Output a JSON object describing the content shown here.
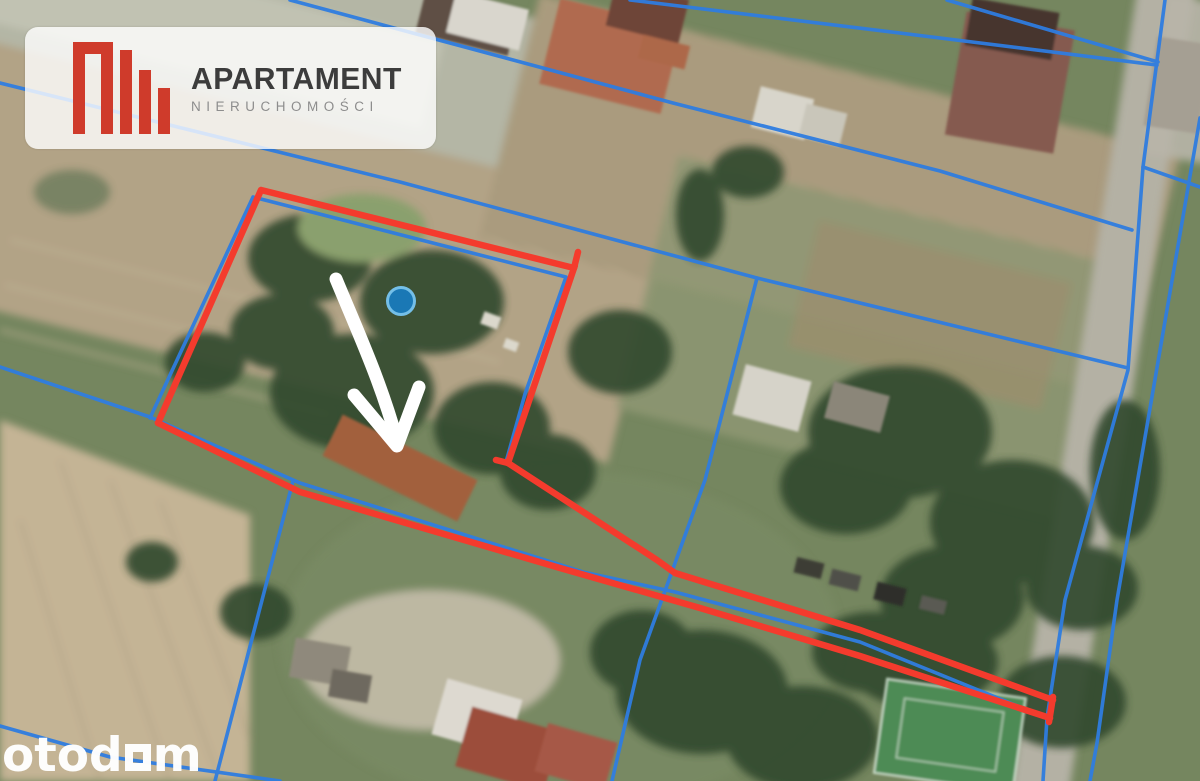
{
  "branding": {
    "agency": {
      "name": "APARTAMENT",
      "tagline": "NIERUCHOMOŚCI",
      "logo_color": "#cf3b2b",
      "name_color": "#3c3c3c",
      "tagline_color": "#8d8d8d"
    },
    "watermark": {
      "prefix": "otod",
      "suffix": "m",
      "square_glyph": "otodom-square-o",
      "color": "#ffffff"
    }
  },
  "map": {
    "type": "satellite-aerial-view",
    "overlays": {
      "property_boundary": {
        "label": "red-property-outline",
        "color": "#f43b2d"
      },
      "cadastral_lines": {
        "label": "blue-parcel-lines",
        "color": "#2f7de0"
      },
      "marker_dot": {
        "fill": "#1a78b5",
        "stroke": "#74bfe8"
      },
      "pointer_arrow": {
        "color": "#ffffff"
      }
    }
  }
}
